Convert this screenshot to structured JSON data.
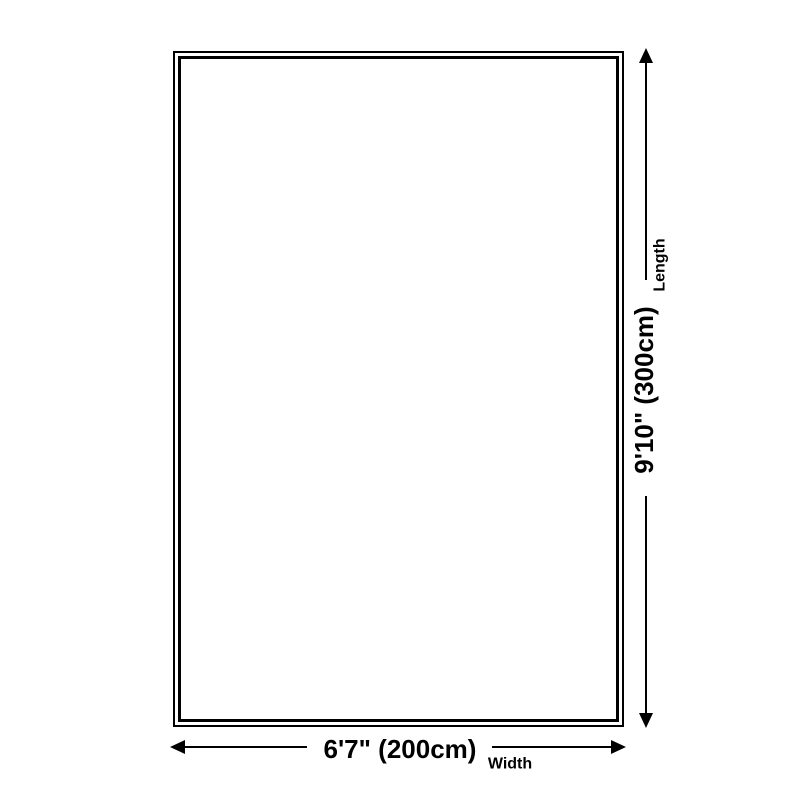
{
  "diagram": {
    "type": "product-dimension-diagram",
    "background_color": "#ffffff",
    "line_color": "#000000",
    "shape": "rectangle",
    "length": {
      "value": "9'10\" (300cm)",
      "axis": "Length"
    },
    "width": {
      "value": "6'7\" (200cm)",
      "axis": "Width"
    }
  }
}
